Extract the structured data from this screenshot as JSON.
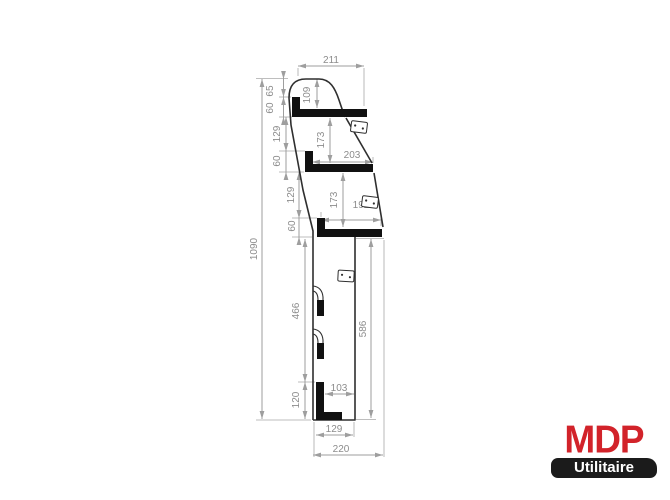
{
  "drawing": {
    "title": "van-racking-side-profile",
    "dims": {
      "overall_height": "1090",
      "overall_depth": "220",
      "top_width": "211",
      "top_clearance": "109",
      "top_setback": "65",
      "shelf1_lip": "60",
      "gap1": "129",
      "shelf1_to_shelf2": "173",
      "shelf2_lip": "60",
      "shelf2_width": "203",
      "gap2": "129",
      "shelf2_to_shelf3": "173",
      "shelf3_lip": "60",
      "shelf3_width": "192",
      "lower_left_height": "466",
      "lower_front_height": "586",
      "base_height": "120",
      "base_inner_depth": "103",
      "base_depth": "129"
    }
  },
  "logo": {
    "brand": "MDP",
    "subtitle": "Utilitaire",
    "brand_color": "#d2232a",
    "banner_bg": "#1b1b1b",
    "banner_text_color": "#ffffff"
  },
  "colors": {
    "background": "#ffffff",
    "outline": "#2f2f2f",
    "solid_fill": "#111111",
    "dimension_lines": "#9e9e9e",
    "dimension_text": "#8c8c8c"
  }
}
